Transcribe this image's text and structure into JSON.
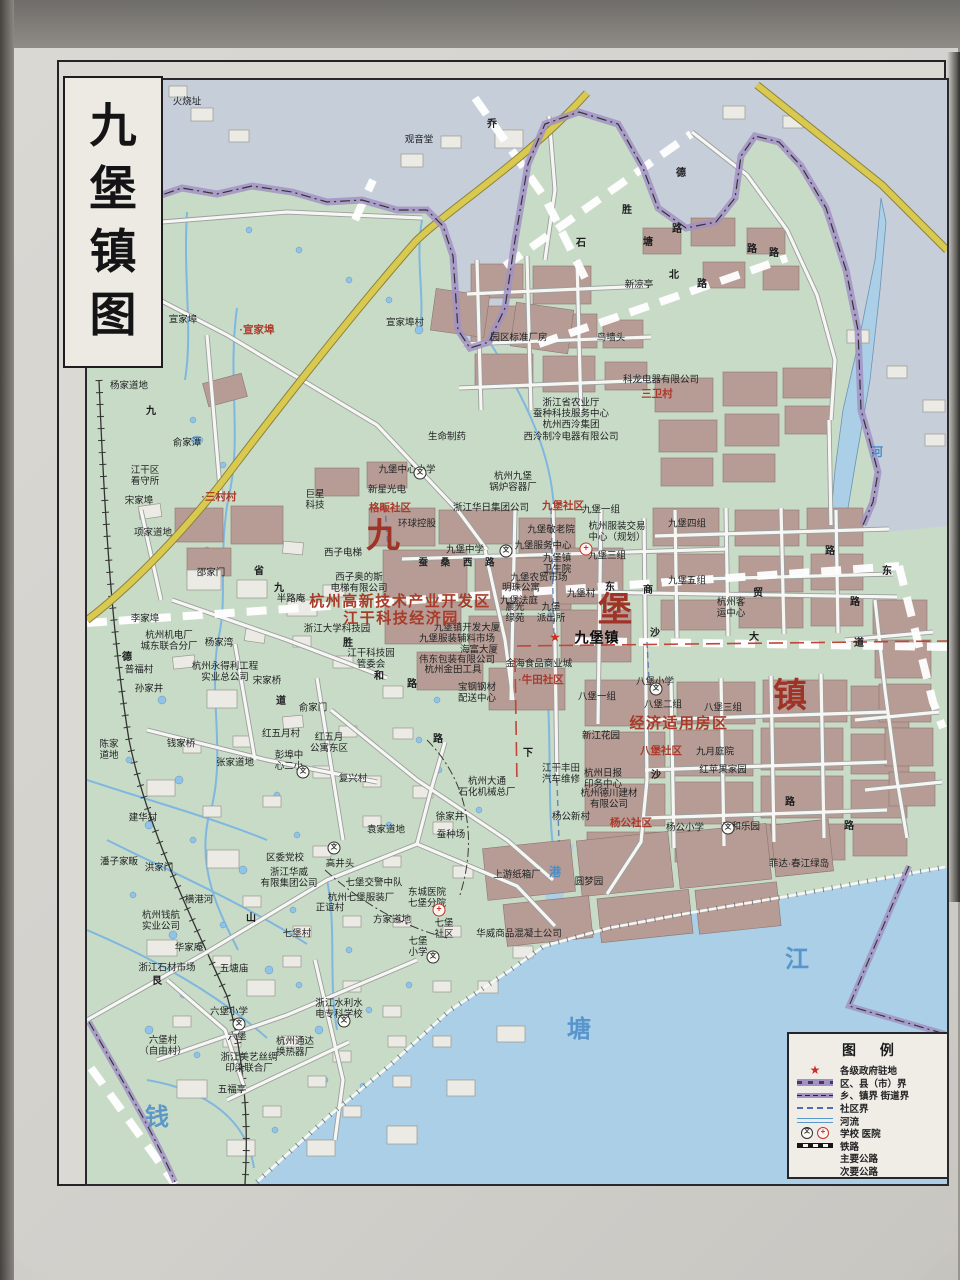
{
  "title": {
    "text": "九堡镇图",
    "chars": [
      "九",
      "堡",
      "镇",
      "图"
    ]
  },
  "colors": {
    "land": "#c8dbc6",
    "outside": "#c6cfd9",
    "water": "#aacfe6",
    "building": "#b69c94",
    "boundary_purple": "#a292c4",
    "highway_yellow": "#d9c94e",
    "red_label": "#ab3a2c",
    "blue_label": "#4a8cc8"
  },
  "legend": {
    "title": "图  例",
    "items": [
      {
        "symbol": "star",
        "label": "各级政府驻地",
        "glyph": "★"
      },
      {
        "symbol": "district",
        "label": "区、县（市）界"
      },
      {
        "symbol": "town",
        "label": "乡、镇界 街道界"
      },
      {
        "symbol": "community",
        "label": "社区界"
      },
      {
        "symbol": "river",
        "label": "河流"
      },
      {
        "symbol": "school-hospital",
        "label": "学校 医院",
        "glyphs": [
          "文",
          "+"
        ]
      },
      {
        "symbol": "railway",
        "label": "铁路"
      },
      {
        "symbol": "major-road",
        "label": "主要公路"
      },
      {
        "symbol": "minor-road",
        "label": "次要公路"
      }
    ]
  },
  "map": {
    "labels": [
      {
        "t": "火烧址",
        "x": 100,
        "y": 22
      },
      {
        "t": "观音堂",
        "x": 332,
        "y": 60
      },
      {
        "t": "宣家埠",
        "x": 96,
        "y": 240
      },
      {
        "t": "·宣家埠",
        "x": 170,
        "y": 250,
        "c": "red"
      },
      {
        "t": "宣家埠村",
        "x": 318,
        "y": 243
      },
      {
        "t": "杨家道地",
        "x": 42,
        "y": 306
      },
      {
        "t": "俞家潭",
        "x": 100,
        "y": 363
      },
      {
        "t": "九",
        "x": 64,
        "y": 332,
        "c": "road"
      },
      {
        "t": "新凉亭",
        "x": 552,
        "y": 205
      },
      {
        "t": "园区标准厂房",
        "x": 432,
        "y": 258
      },
      {
        "t": "鸟墙头",
        "x": 524,
        "y": 258
      },
      {
        "t": "科龙电器有限公司",
        "x": 574,
        "y": 300
      },
      {
        "t": "三卫村",
        "x": 570,
        "y": 314,
        "c": "red"
      },
      {
        "t": "浙江省农业厅\n蚕种科技服务中心\n杭州西泠集团\n西泠制冷电器有限公司",
        "x": 484,
        "y": 340
      },
      {
        "t": "江干区\n看守所",
        "x": 58,
        "y": 396
      },
      {
        "t": "宋家埠",
        "x": 52,
        "y": 421
      },
      {
        "t": "·三村村",
        "x": 132,
        "y": 417,
        "c": "red"
      },
      {
        "t": "项家道地",
        "x": 66,
        "y": 453
      },
      {
        "t": "邵家门",
        "x": 124,
        "y": 493
      },
      {
        "t": "半路庵",
        "x": 204,
        "y": 519
      },
      {
        "t": "省",
        "x": 172,
        "y": 492,
        "c": "road"
      },
      {
        "t": "九",
        "x": 192,
        "y": 509,
        "c": "road"
      },
      {
        "t": "李家埠",
        "x": 58,
        "y": 539
      },
      {
        "t": "杭州机电厂\n城东联合分厂",
        "x": 82,
        "y": 561
      },
      {
        "t": "杨家湾",
        "x": 132,
        "y": 563
      },
      {
        "t": "德",
        "x": 40,
        "y": 578,
        "c": "road"
      },
      {
        "t": "普福村",
        "x": 52,
        "y": 590
      },
      {
        "t": "杭州永得利工程\n实业总公司",
        "x": 138,
        "y": 592
      },
      {
        "t": "宋家桥",
        "x": 180,
        "y": 601
      },
      {
        "t": "孙家井",
        "x": 62,
        "y": 609
      },
      {
        "t": "巨星\n科技",
        "x": 228,
        "y": 420
      },
      {
        "t": "新星光电",
        "x": 300,
        "y": 410
      },
      {
        "t": "格畈社区",
        "x": 303,
        "y": 428,
        "c": "red"
      },
      {
        "t": "环球控股",
        "x": 330,
        "y": 444
      },
      {
        "t": "西子电梯",
        "x": 256,
        "y": 473
      },
      {
        "t": "西子奥的斯\n电梯有限公司",
        "x": 272,
        "y": 503
      },
      {
        "t": "浙江大学科技园",
        "x": 250,
        "y": 549
      },
      {
        "t": "胜",
        "x": 261,
        "y": 564,
        "c": "road"
      },
      {
        "t": "江干科技园\n管委会",
        "x": 284,
        "y": 579
      },
      {
        "t": "生命制药",
        "x": 360,
        "y": 357
      },
      {
        "t": "九堡中心小学",
        "x": 320,
        "y": 390
      },
      {
        "t": "浙江华日集团公司",
        "x": 404,
        "y": 428
      },
      {
        "t": "九堡社区",
        "x": 476,
        "y": 426,
        "c": "red"
      },
      {
        "t": "杭州九堡\n锅炉容器厂",
        "x": 426,
        "y": 402
      },
      {
        "t": "九堡中学",
        "x": 378,
        "y": 470
      },
      {
        "t": "蚕 桑 西 路",
        "x": 372,
        "y": 483,
        "c": "roadsp"
      },
      {
        "t": "九堡敬老院",
        "x": 464,
        "y": 450
      },
      {
        "t": "九堡服务中心",
        "x": 456,
        "y": 466
      },
      {
        "t": "九堡镇\n卫生院",
        "x": 470,
        "y": 484
      },
      {
        "t": "九堡农贸市场",
        "x": 452,
        "y": 498
      },
      {
        "t": "明珠公寓",
        "x": 434,
        "y": 508
      },
      {
        "t": "九堡法庭",
        "x": 432,
        "y": 521
      },
      {
        "t": "晨光\n绿苑",
        "x": 428,
        "y": 533
      },
      {
        "t": "九堡\n派出所",
        "x": 464,
        "y": 533
      },
      {
        "t": "九堡村",
        "x": 494,
        "y": 514
      },
      {
        "t": "九堡一组",
        "x": 514,
        "y": 430
      },
      {
        "t": "杭州服装交易\n中心（规划）",
        "x": 530,
        "y": 452
      },
      {
        "t": "九堡三组",
        "x": 520,
        "y": 476
      },
      {
        "t": "九堡四组",
        "x": 600,
        "y": 444
      },
      {
        "t": "九堡五组",
        "x": 600,
        "y": 501
      },
      {
        "t": "杭州客\n运中心",
        "x": 644,
        "y": 528
      },
      {
        "t": "九堡镇",
        "x": 510,
        "y": 558,
        "c": "town"
      },
      {
        "t": "金海食品商业城",
        "x": 452,
        "y": 584
      },
      {
        "t": "·牛田社区",
        "x": 454,
        "y": 600,
        "c": "red"
      },
      {
        "t": "九堡镇开发大厦",
        "x": 380,
        "y": 548
      },
      {
        "t": "九堡服装辅料市场",
        "x": 370,
        "y": 559
      },
      {
        "t": "海富大厦",
        "x": 392,
        "y": 570
      },
      {
        "t": "伟东包装有限公司",
        "x": 370,
        "y": 580
      },
      {
        "t": "杭州金田工具",
        "x": 366,
        "y": 590
      },
      {
        "t": "宝钢钢材\n配送中心",
        "x": 390,
        "y": 613
      },
      {
        "t": "八堡小学",
        "x": 568,
        "y": 602
      },
      {
        "t": "八堡一组",
        "x": 510,
        "y": 617
      },
      {
        "t": "八堡二组",
        "x": 576,
        "y": 625
      },
      {
        "t": "八堡三组",
        "x": 636,
        "y": 628
      },
      {
        "t": "经济适用房区",
        "x": 592,
        "y": 644,
        "c": "redlg"
      },
      {
        "t": "新江花园",
        "x": 514,
        "y": 656
      },
      {
        "t": "八堡社区",
        "x": 574,
        "y": 671,
        "c": "red"
      },
      {
        "t": "九月庭院",
        "x": 628,
        "y": 672
      },
      {
        "t": "红苹果家园",
        "x": 636,
        "y": 690
      },
      {
        "t": "江干丰田\n汽车维修",
        "x": 474,
        "y": 694
      },
      {
        "t": "杭州日报\n印务中心",
        "x": 516,
        "y": 699
      },
      {
        "t": "杭州德川建材\n有限公司",
        "x": 522,
        "y": 719
      },
      {
        "t": "杨公新村",
        "x": 484,
        "y": 737
      },
      {
        "t": "杨公社区",
        "x": 544,
        "y": 743,
        "c": "red"
      },
      {
        "t": "杨公小学",
        "x": 598,
        "y": 748
      },
      {
        "t": "嘉和乐园",
        "x": 654,
        "y": 747
      },
      {
        "t": "菲达·春江绿岛",
        "x": 712,
        "y": 784
      },
      {
        "t": "圆梦园",
        "x": 502,
        "y": 802
      },
      {
        "t": "上游纸箱厂",
        "x": 430,
        "y": 795
      },
      {
        "t": "港",
        "x": 468,
        "y": 792,
        "c": "blue"
      },
      {
        "t": "华威商品混凝土公司",
        "x": 432,
        "y": 854
      },
      {
        "t": "七堡\n社区",
        "x": 357,
        "y": 849
      },
      {
        "t": "七堡\n小学",
        "x": 331,
        "y": 867
      },
      {
        "t": "东城医院\n七堡分院",
        "x": 340,
        "y": 818
      },
      {
        "t": "方家道地",
        "x": 305,
        "y": 840
      },
      {
        "t": "正谊村",
        "x": 243,
        "y": 828
      },
      {
        "t": "杭州七堡服装厂",
        "x": 274,
        "y": 818
      },
      {
        "t": "七堡交警中队",
        "x": 287,
        "y": 803
      },
      {
        "t": "高井头",
        "x": 253,
        "y": 784
      },
      {
        "t": "袁家道地",
        "x": 299,
        "y": 750
      },
      {
        "t": "徐家井",
        "x": 363,
        "y": 737
      },
      {
        "t": "蚕种场",
        "x": 364,
        "y": 755
      },
      {
        "t": "复兴村",
        "x": 266,
        "y": 699
      },
      {
        "t": "杭州大通\n石化机械总厂",
        "x": 400,
        "y": 707
      },
      {
        "t": "红五月村",
        "x": 194,
        "y": 654
      },
      {
        "t": "彭埠中\n心二小",
        "x": 202,
        "y": 681
      },
      {
        "t": "红五月\n公寓东区",
        "x": 242,
        "y": 663
      },
      {
        "t": "俞家门",
        "x": 226,
        "y": 628
      },
      {
        "t": "道",
        "x": 194,
        "y": 622,
        "c": "road"
      },
      {
        "t": "陈家\n道地",
        "x": 22,
        "y": 670
      },
      {
        "t": "钱家桥",
        "x": 94,
        "y": 664
      },
      {
        "t": "张家道地",
        "x": 148,
        "y": 683
      },
      {
        "t": "建华村",
        "x": 56,
        "y": 738
      },
      {
        "t": "潘子家畈",
        "x": 32,
        "y": 782
      },
      {
        "t": "洪家门",
        "x": 72,
        "y": 788
      },
      {
        "t": "横港河",
        "x": 112,
        "y": 820
      },
      {
        "t": "杭州钱航\n实业公司",
        "x": 74,
        "y": 841
      },
      {
        "t": "区委党校",
        "x": 198,
        "y": 778
      },
      {
        "t": "浙江华威\n有限集团公司",
        "x": 202,
        "y": 798
      },
      {
        "t": "七堡村",
        "x": 210,
        "y": 854
      },
      {
        "t": "华家庵",
        "x": 102,
        "y": 868
      },
      {
        "t": "浙江石材市场",
        "x": 80,
        "y": 888
      },
      {
        "t": "五塘庙",
        "x": 147,
        "y": 889
      },
      {
        "t": "艮",
        "x": 70,
        "y": 902,
        "c": "road"
      },
      {
        "t": "山",
        "x": 164,
        "y": 839,
        "c": "road"
      },
      {
        "t": "六堡小学",
        "x": 142,
        "y": 932
      },
      {
        "t": "六堡",
        "x": 150,
        "y": 957
      },
      {
        "t": "六堡村\n（自由村）",
        "x": 76,
        "y": 966
      },
      {
        "t": "浙江美艺丝绸\n印染联合厂",
        "x": 162,
        "y": 983
      },
      {
        "t": "五福亭",
        "x": 145,
        "y": 1010
      },
      {
        "t": "杭州通达\n换热器厂",
        "x": 208,
        "y": 967
      },
      {
        "t": "浙江水利水\n电专科学校",
        "x": 252,
        "y": 929
      },
      {
        "t": "杭州高新技术产业开发区",
        "x": 313,
        "y": 522,
        "c": "redlg"
      },
      {
        "t": "江干科技经济园",
        "x": 314,
        "y": 539,
        "c": "redlg"
      },
      {
        "t": "九",
        "x": 296,
        "y": 457,
        "c": "redxl"
      },
      {
        "t": "堡",
        "x": 528,
        "y": 531,
        "c": "redxl"
      },
      {
        "t": "镇",
        "x": 703,
        "y": 617,
        "c": "redxl"
      },
      {
        "t": "钱",
        "x": 70,
        "y": 1038,
        "c": "bluexl"
      },
      {
        "t": "塘",
        "x": 492,
        "y": 950,
        "c": "bluexl"
      },
      {
        "t": "江",
        "x": 710,
        "y": 880,
        "c": "bluexl"
      },
      {
        "t": "河",
        "x": 790,
        "y": 372,
        "c": "blue"
      },
      {
        "t": "德",
        "x": 594,
        "y": 94,
        "c": "road"
      },
      {
        "t": "胜",
        "x": 540,
        "y": 131,
        "c": "road"
      },
      {
        "t": "石",
        "x": 494,
        "y": 164,
        "c": "road"
      },
      {
        "t": "塘",
        "x": 561,
        "y": 163,
        "c": "road"
      },
      {
        "t": "路",
        "x": 590,
        "y": 150,
        "c": "road"
      },
      {
        "t": "北",
        "x": 587,
        "y": 196,
        "c": "road"
      },
      {
        "t": "路",
        "x": 615,
        "y": 205,
        "c": "road"
      },
      {
        "t": "路",
        "x": 665,
        "y": 170,
        "c": "road"
      },
      {
        "t": "路",
        "x": 687,
        "y": 174,
        "c": "road"
      },
      {
        "t": "乔",
        "x": 405,
        "y": 45,
        "c": "road"
      },
      {
        "t": "东",
        "x": 523,
        "y": 508,
        "c": "road"
      },
      {
        "t": "商",
        "x": 561,
        "y": 511,
        "c": "road"
      },
      {
        "t": "贸",
        "x": 671,
        "y": 514,
        "c": "road"
      },
      {
        "t": "路",
        "x": 743,
        "y": 472,
        "c": "road"
      },
      {
        "t": "东",
        "x": 800,
        "y": 492,
        "c": "road"
      },
      {
        "t": "路",
        "x": 768,
        "y": 523,
        "c": "road"
      },
      {
        "t": "沙",
        "x": 568,
        "y": 554,
        "c": "road"
      },
      {
        "t": "大",
        "x": 667,
        "y": 558,
        "c": "road"
      },
      {
        "t": "道",
        "x": 772,
        "y": 564,
        "c": "road"
      },
      {
        "t": "下",
        "x": 441,
        "y": 674,
        "c": "road"
      },
      {
        "t": "沙",
        "x": 569,
        "y": 696,
        "c": "road"
      },
      {
        "t": "路",
        "x": 703,
        "y": 723,
        "c": "road"
      },
      {
        "t": "路",
        "x": 762,
        "y": 747,
        "c": "road"
      },
      {
        "t": "和",
        "x": 292,
        "y": 597,
        "c": "road"
      },
      {
        "t": "路",
        "x": 325,
        "y": 605,
        "c": "road"
      },
      {
        "t": "路",
        "x": 351,
        "y": 660,
        "c": "road"
      },
      {
        "t": "★",
        "x": 468,
        "y": 557,
        "c": "star"
      },
      {
        "t": "文",
        "x": 333,
        "y": 393,
        "c": "sch"
      },
      {
        "t": "文",
        "x": 419,
        "y": 471,
        "c": "sch"
      },
      {
        "t": "文",
        "x": 569,
        "y": 609,
        "c": "sch"
      },
      {
        "t": "文",
        "x": 641,
        "y": 748,
        "c": "sch"
      },
      {
        "t": "文",
        "x": 216,
        "y": 692,
        "c": "sch"
      },
      {
        "t": "文",
        "x": 346,
        "y": 877,
        "c": "sch"
      },
      {
        "t": "文",
        "x": 152,
        "y": 944,
        "c": "sch"
      },
      {
        "t": "文",
        "x": 257,
        "y": 941,
        "c": "sch"
      },
      {
        "t": "文",
        "x": 247,
        "y": 768,
        "c": "sch"
      },
      {
        "t": "+",
        "x": 499,
        "y": 469,
        "c": "hos"
      },
      {
        "t": "+",
        "x": 352,
        "y": 830,
        "c": "hos"
      }
    ]
  }
}
